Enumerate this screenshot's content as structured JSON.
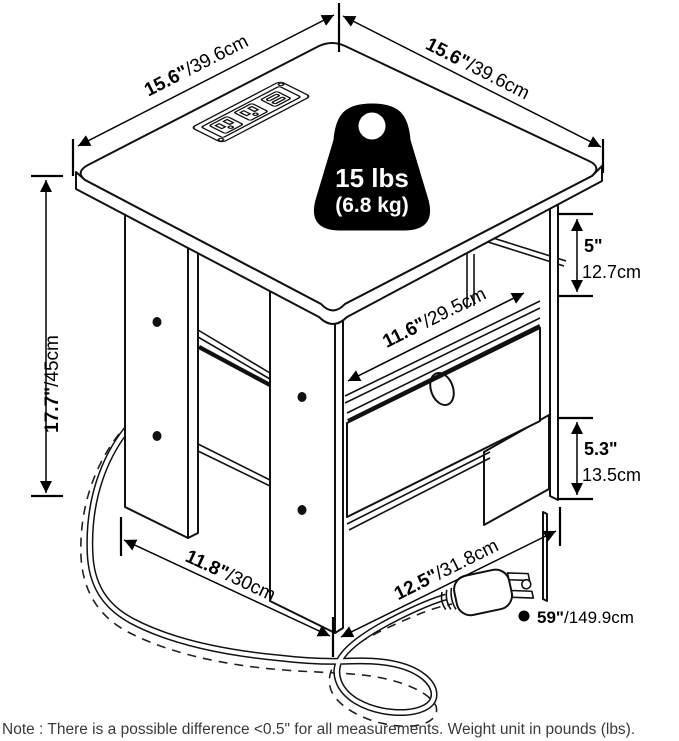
{
  "diagram": {
    "dim_top_left": {
      "in": "15.6\"",
      "cm": "/39.6cm"
    },
    "dim_top_right": {
      "in": "15.6\"",
      "cm": "/39.6cm"
    },
    "dim_height": {
      "in": "17.7\"",
      "cm": "/45cm"
    },
    "dim_gap": {
      "in": "5\"",
      "cm": "12.7cm"
    },
    "dim_bin_width": {
      "in": "11.6\"",
      "cm": "/29.5cm"
    },
    "dim_bin_height": {
      "in": "5.3\"",
      "cm": "13.5cm"
    },
    "dim_depth_left": {
      "in": "11.8\"",
      "cm": "/30cm"
    },
    "dim_depth_right": {
      "in": "12.5\"",
      "cm": "/31.8cm"
    },
    "dim_cord": {
      "in": "59\"",
      "cm": "/149.9cm"
    },
    "weight_badge": {
      "line1": "15 lbs",
      "line2": "(6.8 kg)"
    },
    "note": "Note : There is a possible difference <0.5\" for all measurements. Weight unit in pounds (lbs)."
  }
}
